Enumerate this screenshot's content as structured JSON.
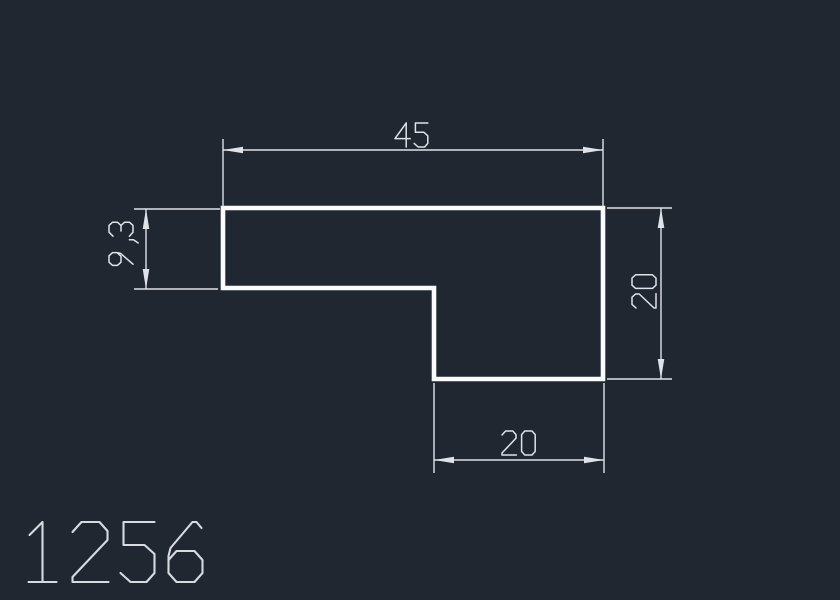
{
  "part_number": "1256",
  "drawing": {
    "canvas": {
      "width": 840,
      "height": 600,
      "background": "#212731"
    },
    "colors": {
      "profile_stroke": "#fafbfc",
      "dimension_stroke": "#dfe3e8",
      "text_stroke": "#dfe3e8",
      "part_label_stroke": "#d7dbe0"
    },
    "profile": {
      "shape": "L-step-profile",
      "stroke_width": 4.6,
      "outline": [
        [
          223,
          208
        ],
        [
          603,
          208
        ],
        [
          603,
          379
        ],
        [
          434,
          379
        ],
        [
          434,
          288
        ],
        [
          223,
          288
        ]
      ]
    },
    "dimensions": [
      {
        "id": "top-width",
        "label": "45",
        "value": 45,
        "dim_line": [
          223,
          150,
          603,
          150
        ],
        "ext_lines": [
          [
            223,
            139,
            223,
            207
          ],
          [
            603,
            139,
            603,
            207
          ]
        ],
        "arrows": [
          {
            "tip": [
              223,
              150
            ],
            "dir": [
              -1,
              0
            ]
          },
          {
            "tip": [
              603,
              150
            ],
            "dir": [
              1,
              0
            ]
          }
        ],
        "text": {
          "pos": [
            412,
            135
          ],
          "rotation": 0,
          "cap": 24
        }
      },
      {
        "id": "left-height",
        "label": "9,3",
        "value": 9.3,
        "dim_line": [
          146,
          209,
          146,
          289
        ],
        "ext_lines": [
          [
            134,
            209,
            220,
            209
          ],
          [
            134,
            289,
            218,
            289
          ]
        ],
        "arrows": [
          {
            "tip": [
              146,
              209
            ],
            "dir": [
              0,
              -1
            ]
          },
          {
            "tip": [
              146,
              289
            ],
            "dir": [
              0,
              1
            ]
          }
        ],
        "text": {
          "pos": [
            121,
            244
          ],
          "rotation": -90,
          "cap": 24
        }
      },
      {
        "id": "right-height",
        "label": "20",
        "value": 20,
        "dim_line": [
          661,
          208,
          661,
          379
        ],
        "ext_lines": [
          [
            607,
            208,
            672,
            208
          ],
          [
            607,
            379,
            672,
            379
          ]
        ],
        "arrows": [
          {
            "tip": [
              661,
              208
            ],
            "dir": [
              0,
              -1
            ]
          },
          {
            "tip": [
              661,
              379
            ],
            "dir": [
              0,
              1
            ]
          }
        ],
        "text": {
          "pos": [
            644,
            291
          ],
          "rotation": -90,
          "cap": 24
        }
      },
      {
        "id": "bottom-width",
        "label": "20",
        "value": 20,
        "dim_line": [
          434,
          460,
          604,
          460
        ],
        "ext_lines": [
          [
            434,
            383,
            434,
            473
          ],
          [
            604,
            383,
            604,
            473
          ]
        ],
        "arrows": [
          {
            "tip": [
              434,
              460
            ],
            "dir": [
              -1,
              0
            ]
          },
          {
            "tip": [
              604,
              460
            ],
            "dir": [
              1,
              0
            ]
          }
        ],
        "text": {
          "pos": [
            519,
            443
          ],
          "rotation": 0,
          "cap": 24
        }
      }
    ],
    "arrow_style": {
      "length": 20,
      "half_width": 3.3
    },
    "line_width": 1.4,
    "part_label": {
      "pos": [
        115,
        552
      ],
      "cap": 60,
      "stroke_width": 2.1
    }
  }
}
